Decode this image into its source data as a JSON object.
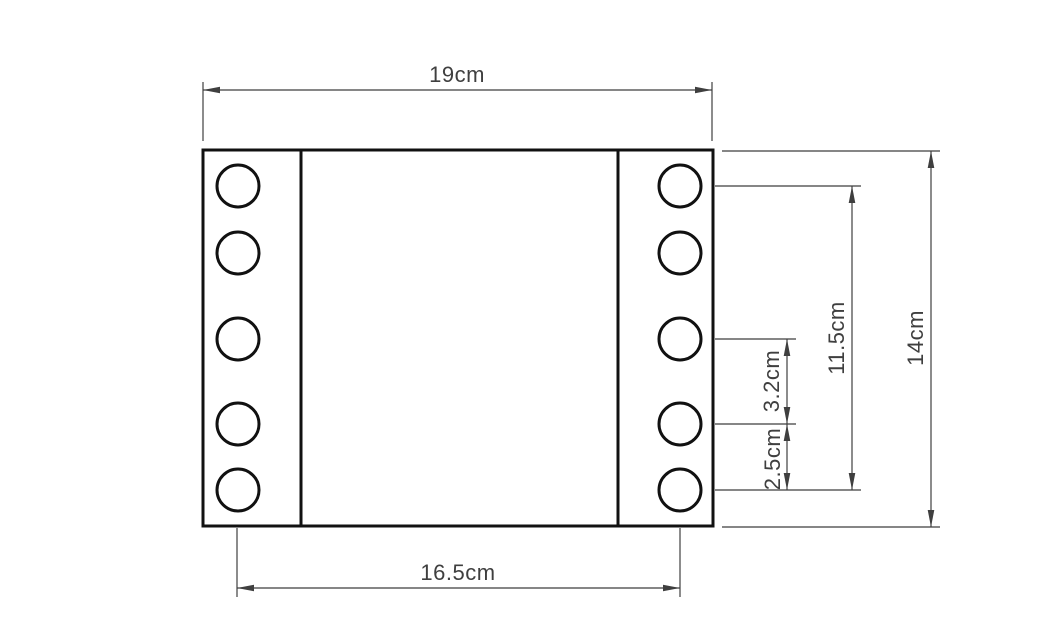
{
  "diagram": {
    "type": "technical-dimension-drawing",
    "subject": "rectangular plate with two vertical rows of five holes",
    "units": "cm",
    "background_color": "#ffffff",
    "outline_color": "#111111",
    "dimension_color": "#3f3f3f",
    "holes": {
      "columns": 2,
      "holes_per_column": 5,
      "vertical_center_gaps_cm": [
        2.5,
        3.2,
        3.2,
        2.5
      ]
    },
    "dimensions": {
      "overall_width": {
        "label": "19cm",
        "value": 19,
        "orientation": "horizontal",
        "position": "top"
      },
      "hole_span_width": {
        "label": "16.5cm",
        "value": 16.5,
        "orientation": "horizontal",
        "position": "bottom"
      },
      "overall_height": {
        "label": "14cm",
        "value": 14,
        "orientation": "vertical",
        "position": "far-right"
      },
      "hole_span_height": {
        "label": "11.5cm",
        "value": 11.5,
        "orientation": "vertical",
        "position": "right"
      },
      "hole_gap_middle": {
        "label": "3.2cm",
        "value": 3.2,
        "orientation": "vertical",
        "position": "right-inner"
      },
      "hole_gap_end": {
        "label": "2.5cm",
        "value": 2.5,
        "orientation": "vertical",
        "position": "right-inner"
      }
    }
  }
}
